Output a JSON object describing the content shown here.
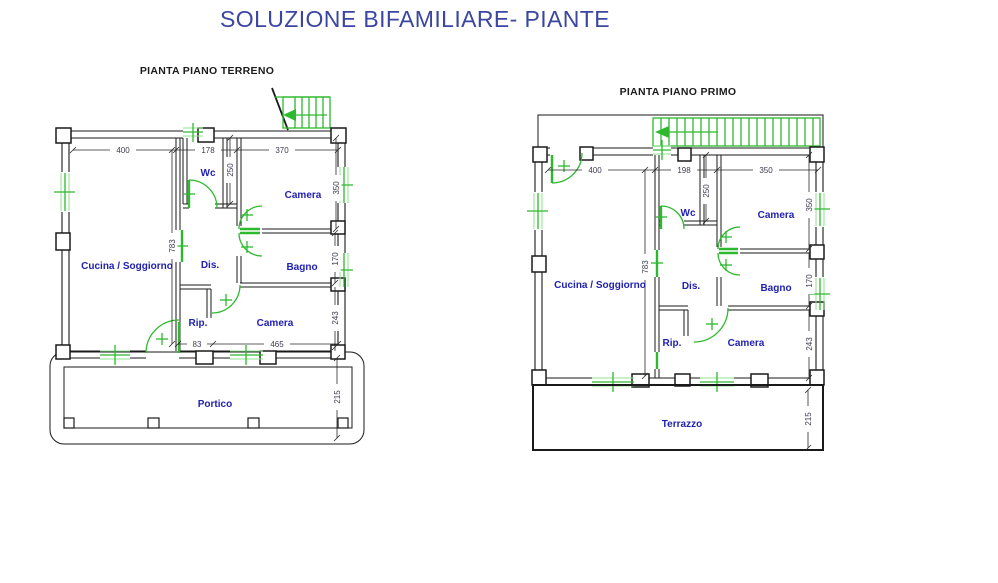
{
  "title": "SOLUZIONE BIFAMILIARE- PIANTE",
  "colors": {
    "title_blue": "#3a46a1",
    "room_label_blue": "#2121b0",
    "line_black": "#1a1a1a",
    "window_stair_green": "#2db92d",
    "dim_text": "#3c3c50"
  },
  "plans": {
    "terreno": {
      "label": "PIANTA PIANO TERRENO",
      "rooms": {
        "wc": "Wc",
        "camera_top": "Camera",
        "cucina": "Cucina / Soggiorno",
        "dis": "Dis.",
        "bagno": "Bagno",
        "rip": "Rip.",
        "camera_bottom": "Camera",
        "portico": "Portico"
      },
      "dims": {
        "w_left": "400",
        "w_mid": "178",
        "w_right": "370",
        "wc_depth": "250",
        "camera_top_h": "350",
        "hall_h": "783",
        "bagno_h": "170",
        "camera_bottom_h": "243",
        "rip_w": "83",
        "camera_w": "465",
        "portico_d": "215"
      }
    },
    "primo": {
      "label": "PIANTA PIANO PRIMO",
      "rooms": {
        "wc": "Wc",
        "camera_top": "Camera",
        "cucina": "Cucina / Soggiorno",
        "dis": "Dis.",
        "bagno": "Bagno",
        "rip": "Rip.",
        "camera_bottom": "Camera",
        "terrazzo": "Terrazzo"
      },
      "dims": {
        "w_left": "400",
        "w_mid": "198",
        "w_right": "350",
        "wc_depth": "250",
        "camera_top_h": "350",
        "hall_h": "783",
        "bagno_h": "170",
        "camera_bottom_h": "243",
        "terrazzo_d": "215"
      }
    }
  }
}
